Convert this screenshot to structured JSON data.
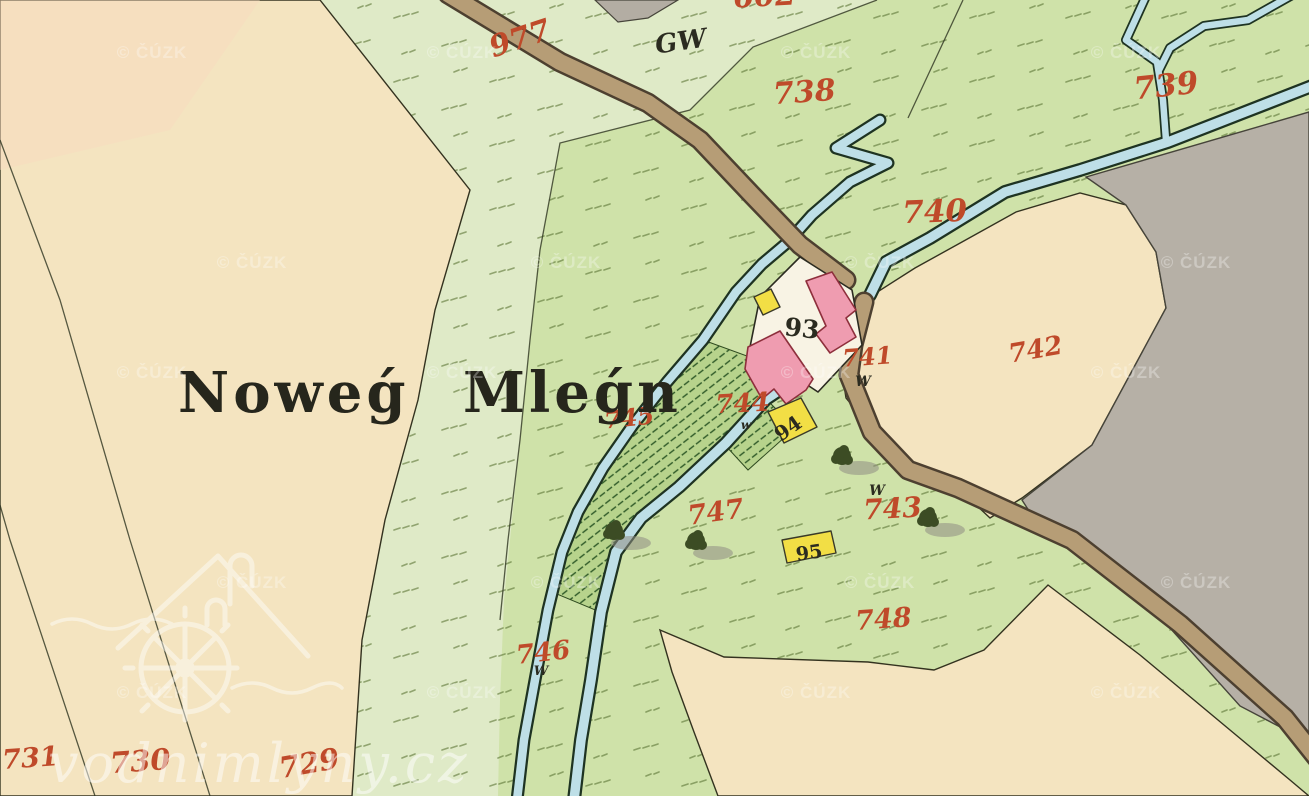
{
  "map": {
    "place_name": "Noweǵ Mleǵn",
    "title_pos": {
      "x": 178,
      "y": 412,
      "size": 56
    },
    "copyright_watermark": {
      "text": "© ČÚZK",
      "rows_y": [
        58,
        268,
        378,
        588,
        698
      ],
      "cols_odd": [
        152,
        462,
        816,
        1126
      ],
      "cols_even": [
        252,
        566,
        880,
        1196
      ]
    },
    "site_watermark": {
      "text": "vodnimlyny.cz"
    },
    "red_parcel_numbers": [
      {
        "label": "602",
        "x": 765,
        "y": 6,
        "rot": -3,
        "size": 30
      },
      {
        "label": "977",
        "x": 523,
        "y": 48,
        "rot": -18,
        "size": 30
      },
      {
        "label": "738",
        "x": 805,
        "y": 102,
        "rot": -4,
        "size": 30
      },
      {
        "label": "739",
        "x": 1167,
        "y": 96,
        "rot": -6,
        "size": 31
      },
      {
        "label": "740",
        "x": 935,
        "y": 222,
        "rot": -2,
        "size": 31
      },
      {
        "label": "741",
        "x": 868,
        "y": 365,
        "rot": -4,
        "size": 24
      },
      {
        "label": "742",
        "x": 1037,
        "y": 358,
        "rot": -10,
        "size": 26
      },
      {
        "label": "743",
        "x": 893,
        "y": 518,
        "rot": -3,
        "size": 28
      },
      {
        "label": "744",
        "x": 743,
        "y": 412,
        "rot": -3,
        "size": 26
      },
      {
        "label": "745",
        "x": 630,
        "y": 426,
        "rot": -6,
        "size": 24
      },
      {
        "label": "746",
        "x": 544,
        "y": 661,
        "rot": -6,
        "size": 26
      },
      {
        "label": "747",
        "x": 717,
        "y": 521,
        "rot": -8,
        "size": 27
      },
      {
        "label": "748",
        "x": 884,
        "y": 628,
        "rot": -4,
        "size": 27
      },
      {
        "label": "729",
        "x": 311,
        "y": 773,
        "rot": -10,
        "size": 29
      },
      {
        "label": "730",
        "x": 141,
        "y": 771,
        "rot": -4,
        "size": 29
      },
      {
        "label": "731",
        "x": 31,
        "y": 767,
        "rot": -4,
        "size": 27
      }
    ],
    "black_labels": [
      {
        "label": "GW",
        "x": 682,
        "y": 50,
        "rot": -8,
        "size": 26,
        "style": "script"
      },
      {
        "label": "93",
        "x": 801,
        "y": 337,
        "rot": 6,
        "size": 25,
        "style": "num"
      },
      {
        "label": "94",
        "x": 792,
        "y": 434,
        "rot": -35,
        "size": 20,
        "style": "num"
      },
      {
        "label": "95",
        "x": 810,
        "y": 559,
        "rot": -8,
        "size": 19,
        "style": "num"
      },
      {
        "label": "W",
        "x": 863,
        "y": 386,
        "rot": 0,
        "size": 14,
        "style": "script"
      },
      {
        "label": "W",
        "x": 877,
        "y": 495,
        "rot": 0,
        "size": 14,
        "style": "script"
      },
      {
        "label": "W",
        "x": 541,
        "y": 675,
        "rot": 0,
        "size": 13,
        "style": "script"
      },
      {
        "label": "w",
        "x": 746,
        "y": 429,
        "rot": 0,
        "size": 12,
        "style": "script"
      }
    ],
    "colors": {
      "meadow": "#cfe2a9",
      "meadow_pale": "#dfeac7",
      "field_beige": "#f4e4c0",
      "field_pink_tint": "#f8d9bf",
      "gray_area": "#b6b0a6",
      "road": "#b69d76",
      "road_edge": "#4d4030",
      "water": "#bedfe7",
      "water_edge": "#1e3322",
      "building_masonry": "#ef9cb0",
      "building_masonry_edge": "#8e2f3c",
      "building_wood": "#f2de45",
      "courtyard": "#f8f3e4",
      "number_red": "#bf4a2a",
      "ink": "#2b2b20",
      "hatch_green": "#2f5a28",
      "tree": "#3c4c24"
    }
  }
}
